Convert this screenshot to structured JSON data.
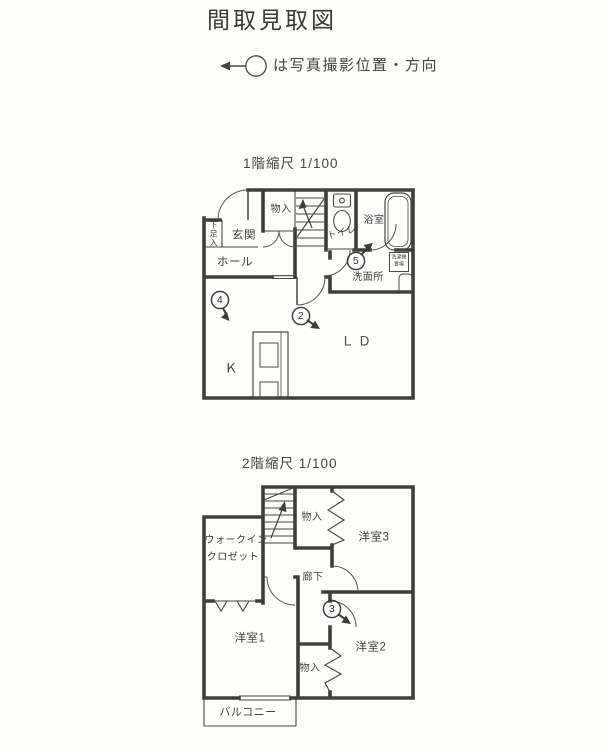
{
  "header": {
    "title": "間取見取図",
    "legend_text": "は写真撮影位置・方向"
  },
  "floor1": {
    "scale_label": "1階縮尺 1/100",
    "rooms": {
      "genkan": "玄関",
      "getabako": "下足入",
      "hall": "ホール",
      "closet": "物入",
      "toilet": "トイレ",
      "bath": "浴室",
      "washroom": "洗面所",
      "living_dining": "ＬＤ",
      "kitchen": "Ｋ",
      "washer_line1": "洗濯機",
      "washer_line2": "置場"
    },
    "markers": {
      "m2": "2",
      "m4": "4",
      "m5": "5"
    }
  },
  "floor2": {
    "scale_label": "2階縮尺 1/100",
    "rooms": {
      "closet_top": "物入",
      "room3": "洋室3",
      "wic_line1": "ウォークイン",
      "wic_line2": "クロゼット",
      "corridor": "廊下",
      "room1": "洋室1",
      "room2": "洋室2",
      "closet_bottom": "物入",
      "balcony": "バルコニー"
    },
    "markers": {
      "m3": "3"
    }
  },
  "colors": {
    "wall": "#3f3e3c",
    "text": "#444341"
  }
}
